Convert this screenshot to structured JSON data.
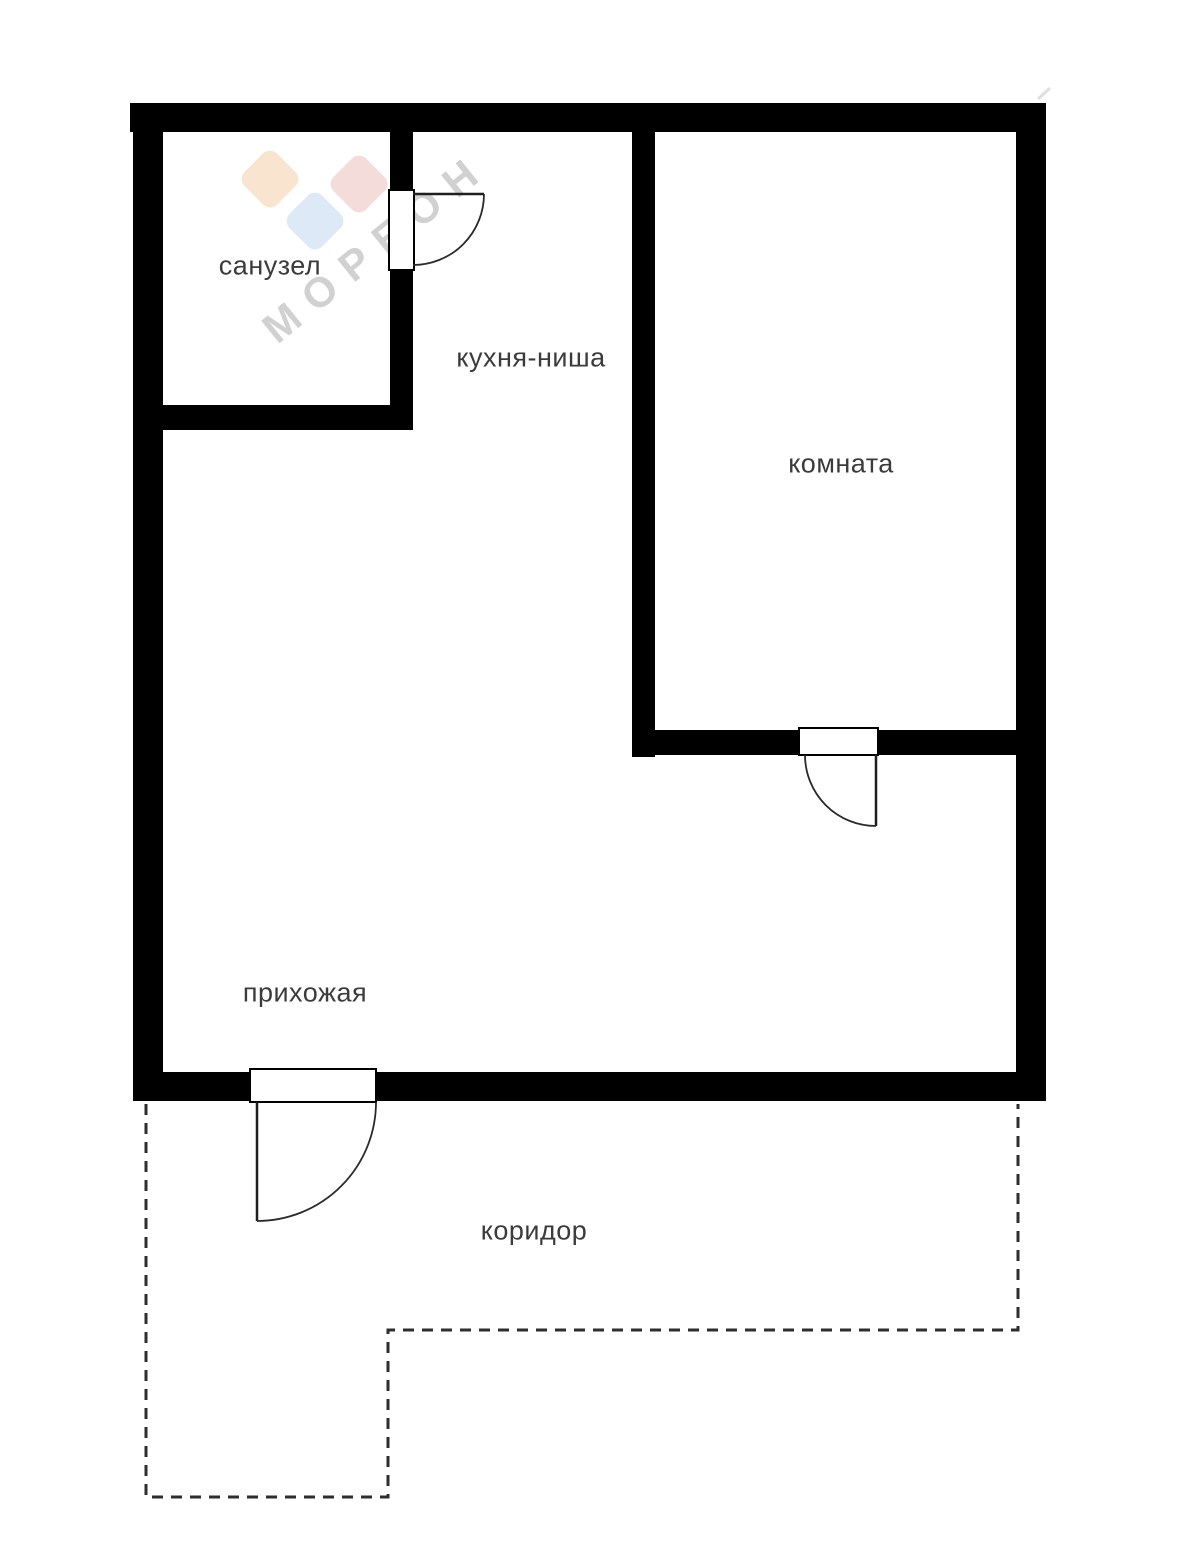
{
  "plan": {
    "type": "apartment-floor-plan",
    "wall_color": "#000000",
    "label_color": "#3b3b3b",
    "dashed_outline_color": "#2e2e2e",
    "background_color": "#ffffff"
  },
  "rooms": {
    "bathroom": "санузел",
    "kitchen_niche": "кухня-ниша",
    "living_room": "комната",
    "hallway": "прихожая",
    "corridor": "коридор"
  },
  "watermark": {
    "text": "МОРЕОН",
    "text_color": "#c9c9c9",
    "diamond_colors": {
      "orange": "#f8e4cf",
      "pink": "#f4dcda",
      "blue": "#dde9f6"
    }
  }
}
